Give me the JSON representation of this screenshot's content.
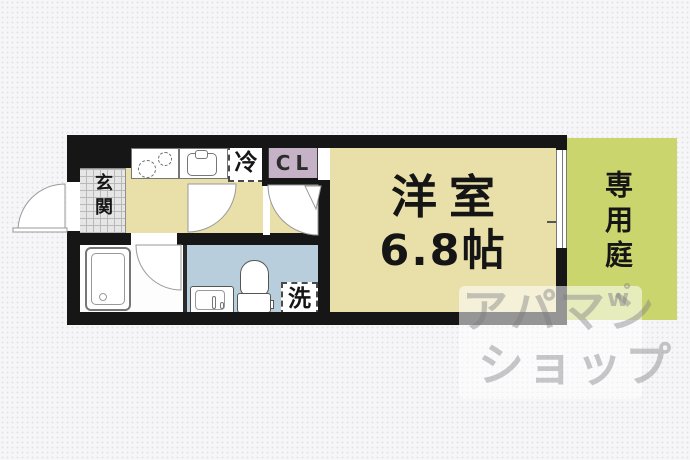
{
  "floorplan": {
    "genkan": {
      "label": "玄関"
    },
    "refrigerator": {
      "label": "冷"
    },
    "closet": {
      "label": "CL"
    },
    "main_room": {
      "name": "洋室",
      "size": "6.8帖"
    },
    "garden": {
      "label": "専用庭"
    },
    "washer": {
      "label": "洗"
    },
    "colors": {
      "floor_tan": "#e9e0a9",
      "garden_green": "#cbd56d",
      "washroom_blue": "#b9cedd",
      "closet_mauve": "#c6b2c7",
      "wall_black": "#161616",
      "background": "#f6f6f8"
    }
  },
  "watermark": {
    "line1": "アパマン",
    "line2": "ショップ",
    "logo_mark": "w"
  }
}
